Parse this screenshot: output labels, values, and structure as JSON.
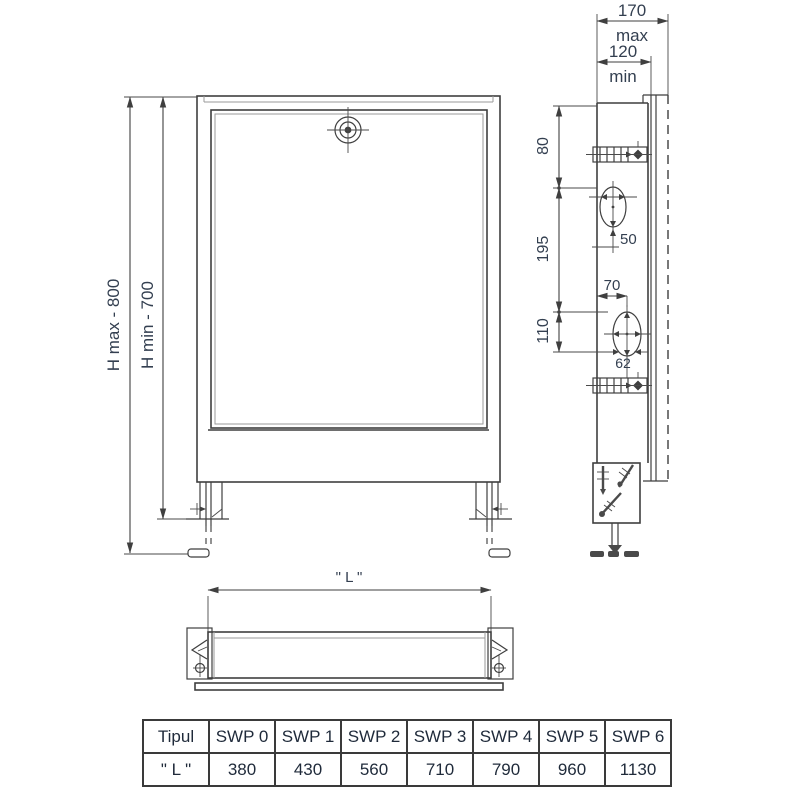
{
  "drawing": {
    "front_view": {
      "h_max_label": "H max - 800",
      "h_min_label": "H min - 700"
    },
    "side_view": {
      "depth_max": "170",
      "depth_max_suffix": "max",
      "depth_min": "120",
      "depth_min_suffix": "min",
      "dims": {
        "v80": "80",
        "v195": "195",
        "v110": "110",
        "v70": "70",
        "v50": "50",
        "v62": "62"
      }
    },
    "bottom_view": {
      "length_label": "\" L \""
    }
  },
  "table": {
    "headers": [
      "Tipul",
      "SWP 0",
      "SWP 1",
      "SWP 2",
      "SWP 3",
      "SWP 4",
      "SWP 5",
      "SWP 6"
    ],
    "values": [
      "\" L \"",
      "380",
      "430",
      "560",
      "710",
      "790",
      "960",
      "1130"
    ]
  },
  "colors": {
    "line": "#3f3f3f",
    "dim_text": "#333f50",
    "table_text": "#1f2a3a",
    "table_border": "#3a3a3a"
  }
}
